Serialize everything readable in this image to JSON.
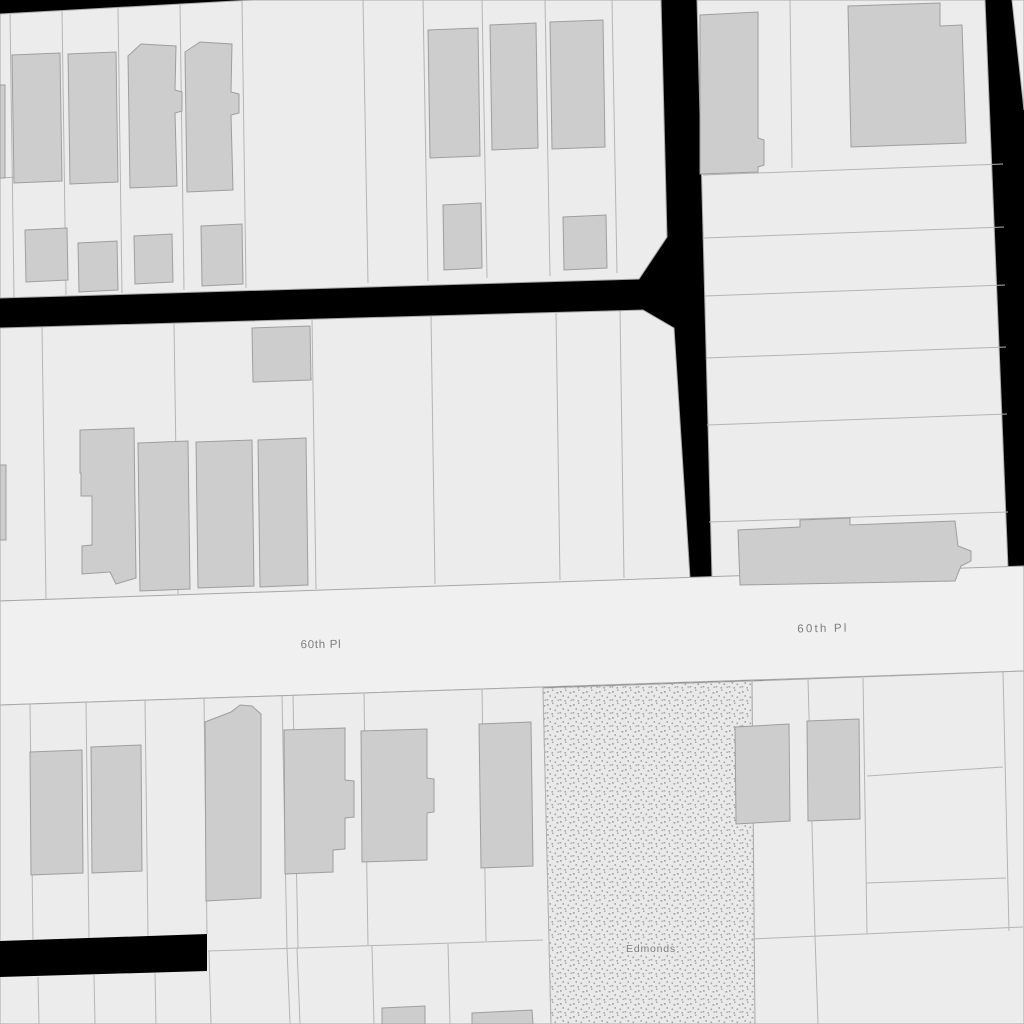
{
  "map": {
    "kind": "cadastral-parcel-map",
    "street_labels": [
      {
        "text": "60th Pl"
      },
      {
        "text": "60th Pl"
      }
    ],
    "area_label": {
      "text": "Edmonds"
    },
    "colors": {
      "background": "#000000",
      "parcel_fill": "#ececec",
      "street_fill": "#f0f0f0",
      "parcel_line": "#b4b4b4",
      "block_outline": "#a8a8a8",
      "building_fill": "#cdcdcd",
      "building_outline": "#9e9e9e",
      "stipple_base": "#e9e9e9",
      "stipple_dot": "#a5a5a5",
      "label_color": "#7d7d7d"
    }
  }
}
